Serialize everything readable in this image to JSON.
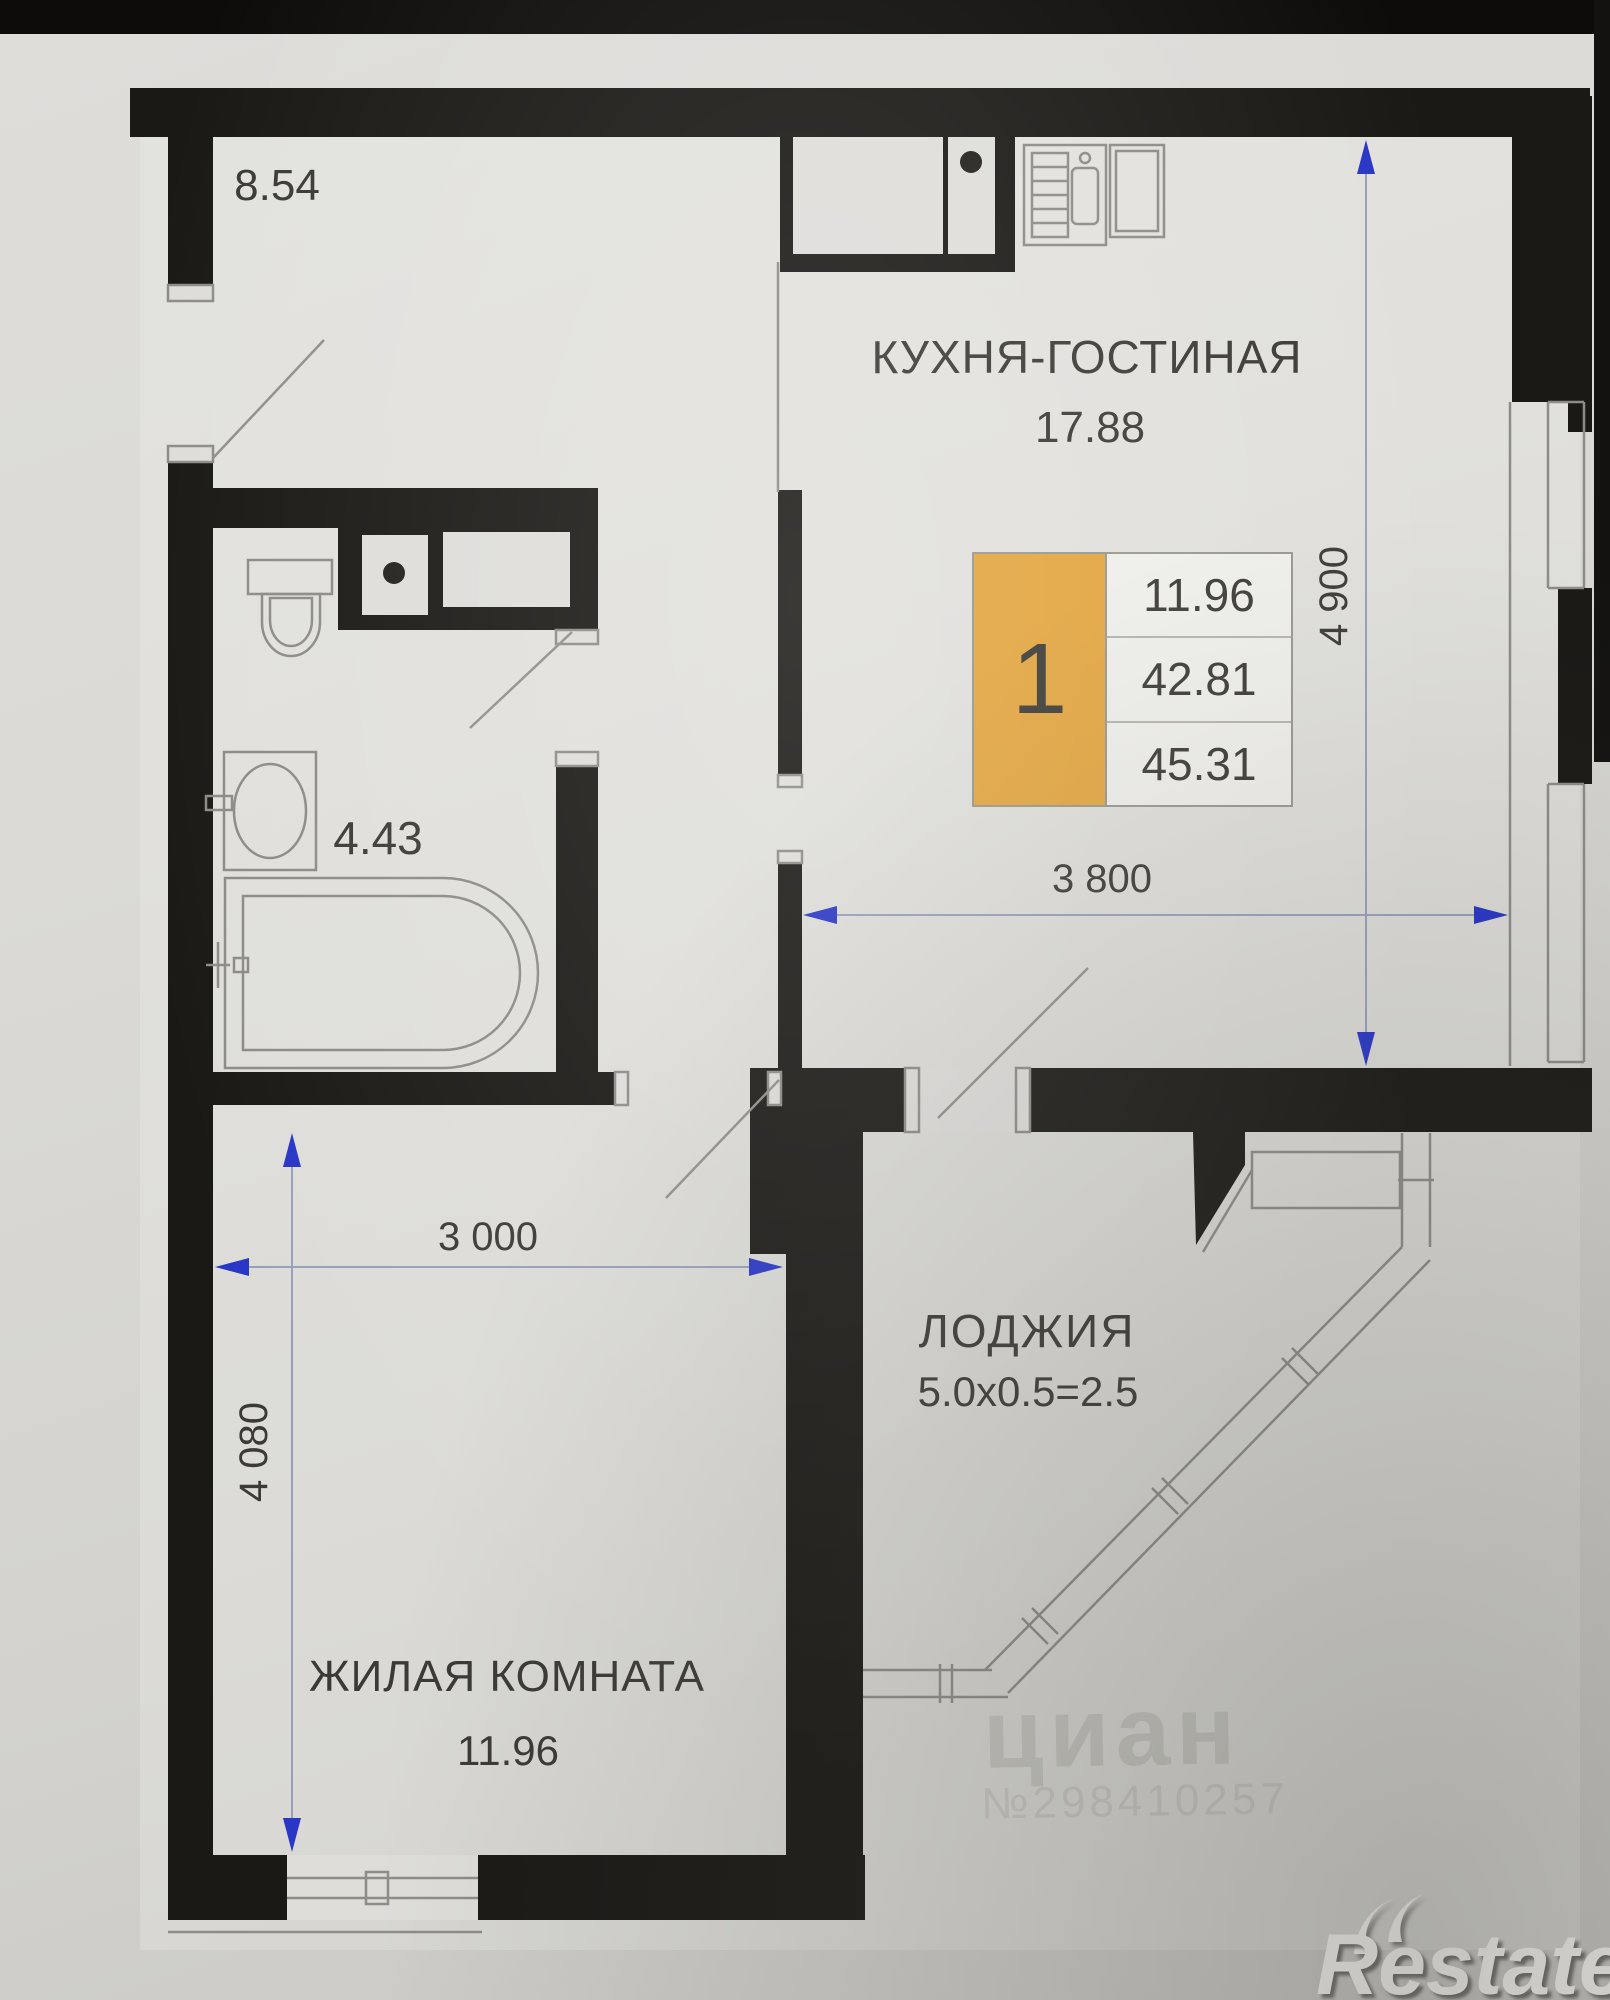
{
  "plan": {
    "rooms": {
      "hallway": {
        "area": "8.54"
      },
      "kitchen_living": {
        "name": "КУХНЯ-ГОСТИНАЯ",
        "area": "17.88"
      },
      "bathroom": {
        "area": "4.43"
      },
      "loggia": {
        "name": "ЛОДЖИЯ",
        "calc": "5.0x0.5=2.5"
      },
      "living_room": {
        "name": "ЖИЛАЯ КОМНАТА",
        "area": "11.96"
      }
    },
    "info_box": {
      "rooms_count": "1",
      "living_area": "11.96",
      "area_no_loggia": "42.81",
      "total_area": "45.31"
    },
    "dimensions": {
      "kitchen_depth": "4 900",
      "kitchen_width": "3 800",
      "living_width": "3 000",
      "living_depth": "4 080"
    }
  },
  "watermark": {
    "brand": "циан",
    "number": "№298410257"
  },
  "logo": {
    "text": "Restate"
  },
  "colors": {
    "wall_black": "#1b1916",
    "accent_orange": "#e3a53f",
    "dimension_blue": "#2936c6",
    "line_gray": "#8d8c88",
    "paper": "#d8d7d3"
  }
}
